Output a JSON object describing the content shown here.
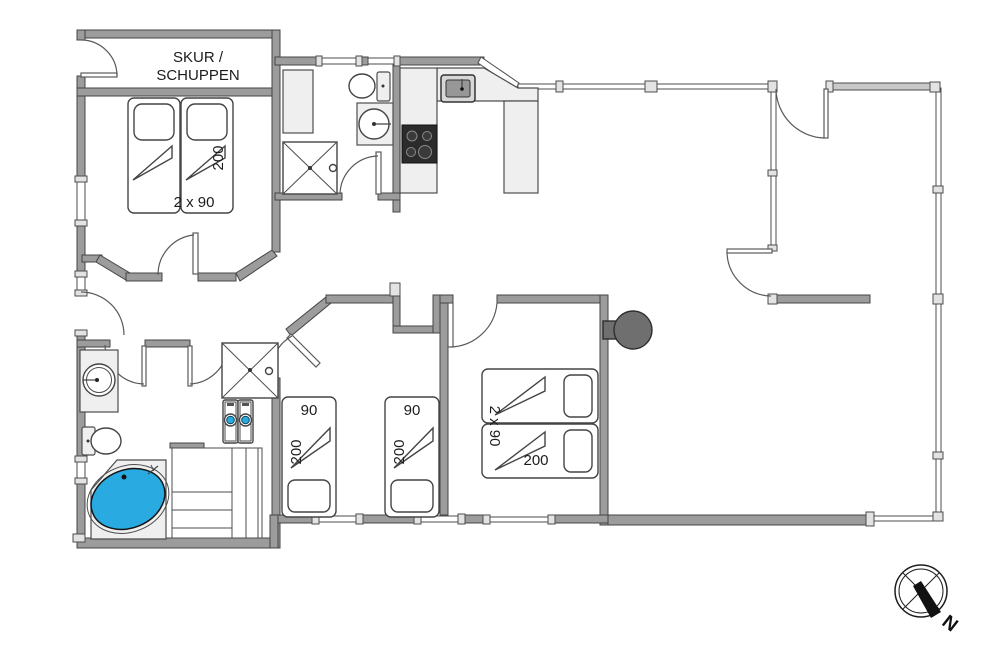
{
  "labels": {
    "shed_line1": "SKUR /",
    "shed_line2": "SCHUPPEN",
    "bed_top_width": "2 x 90",
    "bed_top_length": "200",
    "kids_bed1_width": "90",
    "kids_bed1_length": "200",
    "kids_bed2_width": "90",
    "kids_bed2_length": "200",
    "bed_right_width": "2 x 90",
    "bed_right_length": "200",
    "compass_north": "N"
  },
  "colors": {
    "wall": "#9c9c9c",
    "wall_outline": "#454545",
    "furniture_light": "#efefef",
    "stove": "#2b2b2b",
    "tub_fill": "#29abe2",
    "washer_door": "#29abe2"
  }
}
